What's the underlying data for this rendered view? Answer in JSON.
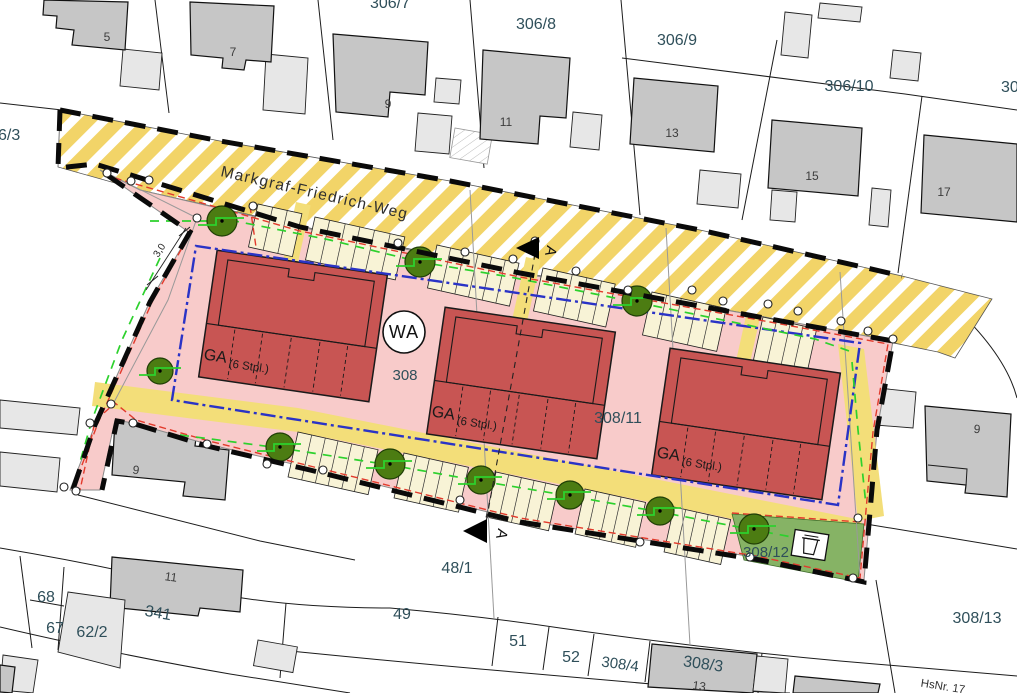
{
  "street": {
    "name": "Markgraf-Friedrich-Weg"
  },
  "zone": {
    "wa": "WA",
    "garage": "GA",
    "garage_capacity": "(6 Stpl.)",
    "dimension_m": "3,0",
    "section": "A"
  },
  "parcels": {
    "p306_3": "6/3",
    "p306_7": "306/7",
    "p306_8": "306/8",
    "p306_9": "306/9",
    "p306_10": "306/10",
    "p306_11": "306/11",
    "p308": "308",
    "p308_11": "308/11",
    "p308_12": "308/12",
    "p308_13": "308/13",
    "p308_3": "308/3",
    "p308_4": "308/4",
    "p48_1": "48/1",
    "p49": "49",
    "p51": "51",
    "p52": "52",
    "p68": "68",
    "p67": "67",
    "p62_2": "62/2",
    "p341": "341"
  },
  "house_numbers": {
    "h5": "5",
    "h7": "7",
    "h9": "9",
    "h11": "11",
    "h13": "13",
    "h15": "15",
    "h17": "17",
    "h9_left": "9",
    "h11_left": "11",
    "h9_right": "9",
    "h13_bottom": "13",
    "hsnr": "HsNr. 17"
  },
  "colors": {
    "street_hatch_yellow": "#f2d468",
    "site_pink": "#f8cbca",
    "driveway_yellow": "#f3de79",
    "stall_cream": "#f8f3d6",
    "building_red": "#c85553",
    "existing_building_gray": "#c6c6c6",
    "outbuilding_gray": "#e7e7e7",
    "tree_green": "#4c7c12",
    "landscape_green": "#2dd12d",
    "area_green": "#86b365",
    "envelope_blue": "#2a33c6",
    "boundary_red": "#e23a2c",
    "plan_boundary_black": "#0a0a0a",
    "label_color": "#2f4f5a"
  }
}
